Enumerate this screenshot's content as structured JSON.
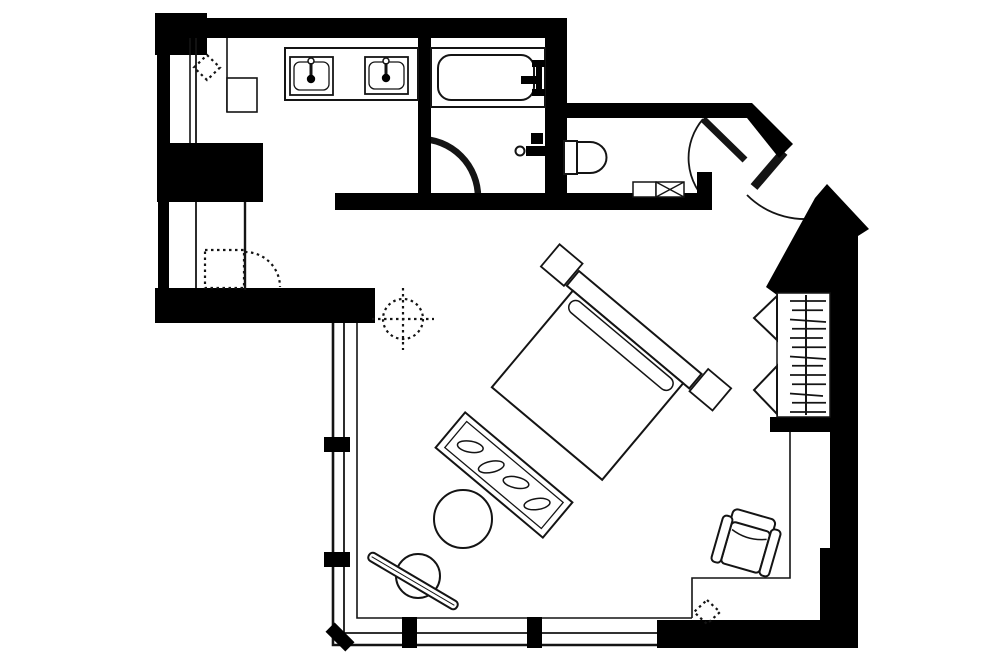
{
  "title": "Hotel guest room floor plan",
  "colors": {
    "background": "#ffffff",
    "wall": "#000000",
    "line": "#141414"
  },
  "rooms": [
    {
      "name": "dressing-vanity-area"
    },
    {
      "name": "bathtub-room"
    },
    {
      "name": "toilet-room"
    },
    {
      "name": "entry-vestibule"
    },
    {
      "name": "bedroom-main-room"
    }
  ],
  "fixtures": {
    "vanity": {
      "sinks": 2,
      "faucets": 2,
      "cabinet_box": 1
    },
    "bathtub": {
      "count": 1,
      "faucet": true
    },
    "shower_valve": 1,
    "toilet": {
      "count": 1,
      "tank": true
    },
    "access_panel_x_box": 1,
    "closet": {
      "hanger_count": 13,
      "rod": true,
      "bifold_markers": 2
    },
    "bed": {
      "nightstands": 2,
      "headboard": true,
      "pillow_row": true
    },
    "foot_bench": {
      "cushions": 4
    },
    "ottoman_stool": 1,
    "round_chair_with_rod": 1,
    "armchair": 1
  },
  "doors": {
    "bathroom_door": "quarter-swing",
    "toilet_door": "quarter-swing",
    "entry_door": "angled-corner-swing",
    "dressing_door": "dashed-optional"
  },
  "windows": {
    "left_wall_mullions": 2,
    "bottom_wall_mullions": 2,
    "corner_mullion": 1
  },
  "symbols": {
    "sprinkler_diamonds": 2,
    "ceiling_fixture_crosshair": 1
  }
}
